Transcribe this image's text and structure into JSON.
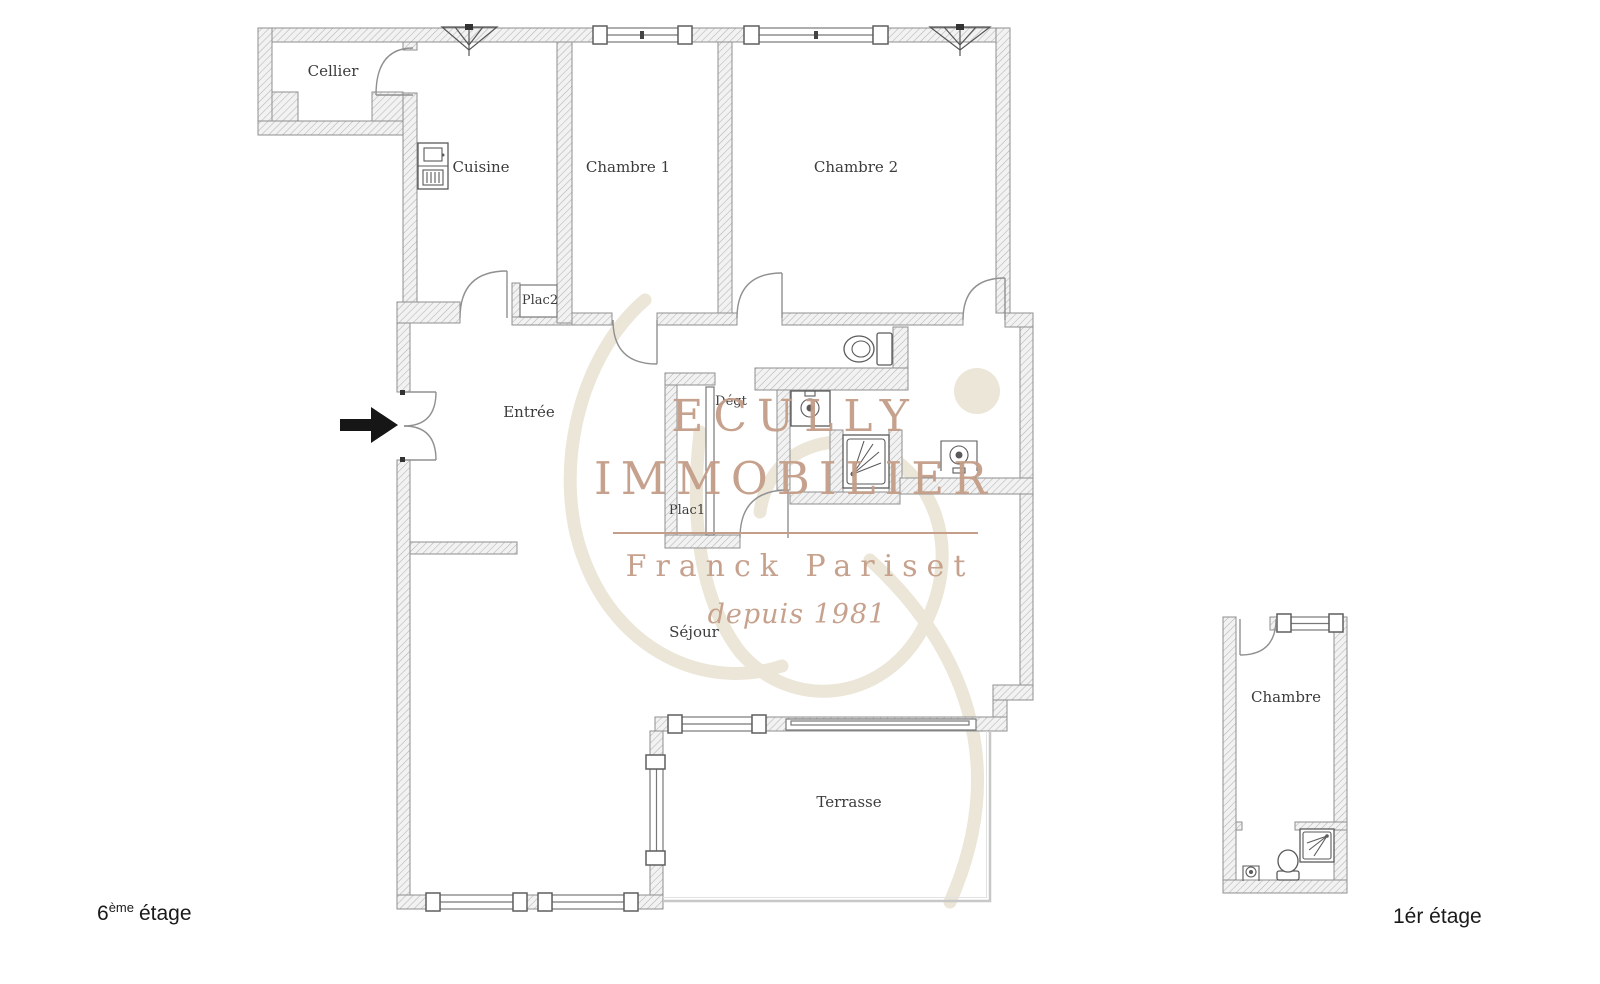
{
  "watermark": {
    "brand_line1": "ECULLY",
    "brand_line2": "IMMOBILIER",
    "name": "Franck Pariset",
    "tagline": "depuis 1981",
    "text_color": "#c49e88",
    "monogram_color": "#ece6d8"
  },
  "main_plan": {
    "rooms": {
      "cellier": "Cellier",
      "cuisine": "Cuisine",
      "chambre1": "Chambre 1",
      "chambre2": "Chambre 2",
      "plac2": "Plac2",
      "entree": "Entrée",
      "degt": "Dégt",
      "plac1": "Plac1",
      "sejour": "Séjour",
      "terrasse": "Terrasse"
    },
    "floor_label": {
      "number": "6",
      "suffix": "ème",
      "rest": "étage"
    },
    "fixtures": [
      "fridge-icon",
      "toilet-icon",
      "sink-icon",
      "shower-icon",
      "washbasin-icon",
      "ventilation-icon",
      "entrance-arrow-icon"
    ]
  },
  "annex_plan": {
    "rooms": {
      "chambre": "Chambre"
    },
    "floor_label": {
      "text": "1ér étage"
    },
    "fixtures": [
      "shower-icon",
      "toilet-icon",
      "sink-icon"
    ]
  },
  "colors": {
    "wall_hatch": "#b4b4b4",
    "wall_fill": "#f2f2f2",
    "wall_outline": "#8f8f8f",
    "label_text": "#3c3c3c",
    "terrace_border": "#c8c8c8",
    "arrow": "#161616"
  }
}
